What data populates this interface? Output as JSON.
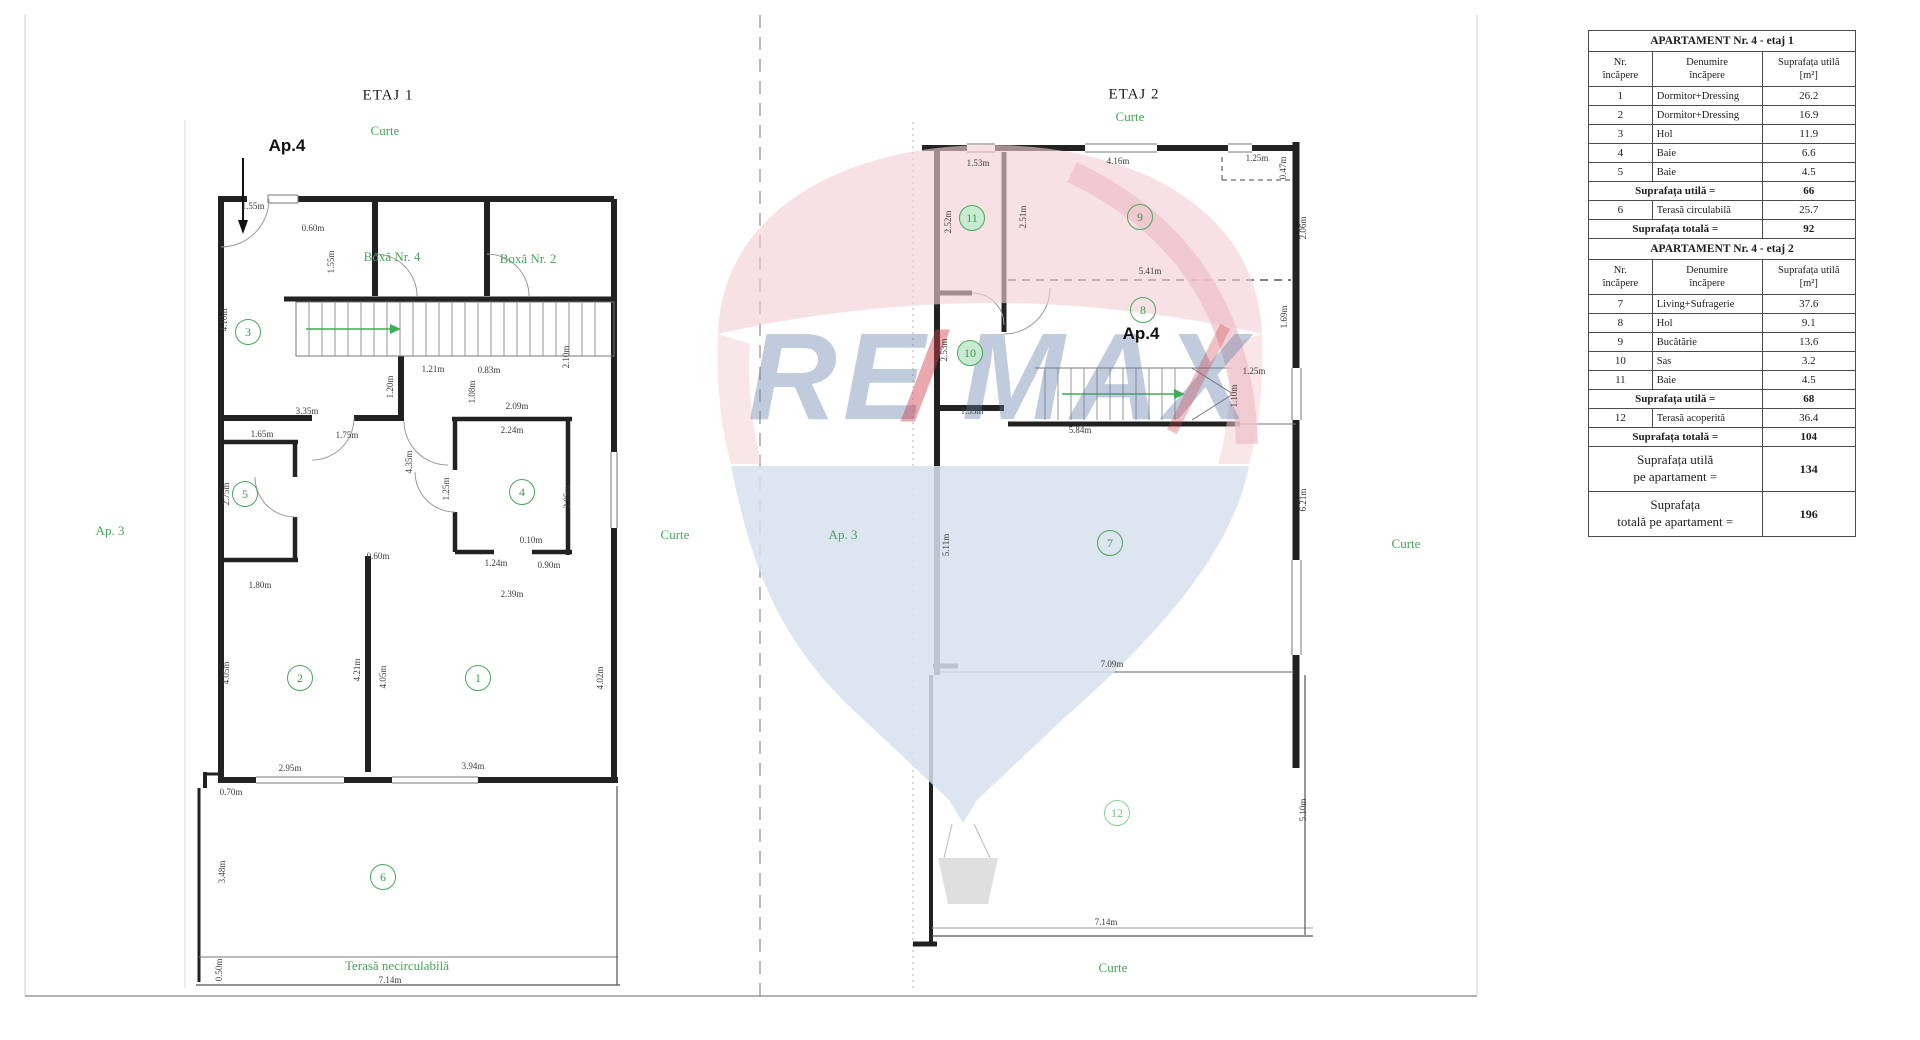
{
  "colors": {
    "green_label": "#46a558",
    "green_circle": "#4aa85c",
    "wall": "#222222",
    "thin_line": "#777777",
    "arrow_green": "#3fae52",
    "watermark_blue": "#617eaa",
    "watermark_red": "#ce424c",
    "balloon_pink": "#f3ced4",
    "balloon_blue": "#d7e0ed"
  },
  "watermark": {
    "re": "RE",
    "slash": "/",
    "max": "MAX"
  },
  "plans": {
    "etaj1": {
      "title": "ETAJ 1",
      "title_pos": {
        "x": 388,
        "y": 96
      },
      "apartment_label": "Ap.4",
      "apartment_pos": {
        "x": 287,
        "y": 146
      },
      "area_labels": [
        {
          "text": "Curte",
          "x": 385,
          "y": 131
        },
        {
          "text": "Boxă Nr. 4",
          "x": 392,
          "y": 257
        },
        {
          "text": "Boxă Nr. 2",
          "x": 528,
          "y": 259
        },
        {
          "text": "Ap. 3",
          "x": 110,
          "y": 531
        },
        {
          "text": "Curte",
          "x": 675,
          "y": 535
        },
        {
          "text": "Terasă necirculabilă",
          "x": 397,
          "y": 966
        }
      ],
      "rooms": [
        {
          "n": "3",
          "x": 248,
          "y": 332
        },
        {
          "n": "5",
          "x": 245,
          "y": 494
        },
        {
          "n": "4",
          "x": 522,
          "y": 492
        },
        {
          "n": "2",
          "x": 300,
          "y": 678
        },
        {
          "n": "1",
          "x": 478,
          "y": 678
        },
        {
          "n": "6",
          "x": 383,
          "y": 877
        }
      ],
      "dims": [
        {
          "t": "1.55m",
          "x": 253,
          "y": 206
        },
        {
          "t": "0.60m",
          "x": 313,
          "y": 228
        },
        {
          "t": "1.55m",
          "x": 331,
          "y": 262,
          "v": true
        },
        {
          "t": "4.10m",
          "x": 224,
          "y": 320,
          "v": true
        },
        {
          "t": "3.35m",
          "x": 307,
          "y": 411
        },
        {
          "t": "1.21m",
          "x": 433,
          "y": 369
        },
        {
          "t": "0.83m",
          "x": 489,
          "y": 370
        },
        {
          "t": "1.20m",
          "x": 390,
          "y": 387,
          "v": true
        },
        {
          "t": "1.08m",
          "x": 472,
          "y": 392,
          "v": true
        },
        {
          "t": "2.10m",
          "x": 566,
          "y": 357,
          "v": true
        },
        {
          "t": "1.65m",
          "x": 262,
          "y": 434
        },
        {
          "t": "1.75m",
          "x": 347,
          "y": 435
        },
        {
          "t": "2.09m",
          "x": 517,
          "y": 406
        },
        {
          "t": "2.24m",
          "x": 512,
          "y": 430
        },
        {
          "t": "2.75m",
          "x": 226,
          "y": 494,
          "v": true
        },
        {
          "t": "1.25m",
          "x": 446,
          "y": 489,
          "v": true
        },
        {
          "t": "4.35m",
          "x": 409,
          "y": 462,
          "v": true
        },
        {
          "t": "2.05m",
          "x": 567,
          "y": 497,
          "v": true
        },
        {
          "t": "0.10m",
          "x": 531,
          "y": 540
        },
        {
          "t": "1.24m",
          "x": 496,
          "y": 563
        },
        {
          "t": "0.90m",
          "x": 549,
          "y": 565
        },
        {
          "t": "0.60m",
          "x": 378,
          "y": 556
        },
        {
          "t": "1.80m",
          "x": 260,
          "y": 585
        },
        {
          "t": "2.39m",
          "x": 512,
          "y": 594
        },
        {
          "t": "4.05m",
          "x": 226,
          "y": 673,
          "v": true
        },
        {
          "t": "4.21m",
          "x": 357,
          "y": 670,
          "v": true
        },
        {
          "t": "4.05m",
          "x": 383,
          "y": 677,
          "v": true
        },
        {
          "t": "4.02m",
          "x": 600,
          "y": 678,
          "v": true
        },
        {
          "t": "2.95m",
          "x": 290,
          "y": 768
        },
        {
          "t": "3.94m",
          "x": 473,
          "y": 766
        },
        {
          "t": "0.70m",
          "x": 231,
          "y": 792
        },
        {
          "t": "3.48m",
          "x": 222,
          "y": 872,
          "v": true
        },
        {
          "t": "0.50m",
          "x": 219,
          "y": 970,
          "v": true
        },
        {
          "t": "7.14m",
          "x": 390,
          "y": 980
        }
      ]
    },
    "etaj2": {
      "title": "ETAJ 2",
      "title_pos": {
        "x": 1134,
        "y": 95
      },
      "apartment_label": "Ap.4",
      "apartment_pos": {
        "x": 1141,
        "y": 334
      },
      "area_labels": [
        {
          "text": "Curte",
          "x": 1130,
          "y": 117
        },
        {
          "text": "Ap. 3",
          "x": 843,
          "y": 535
        },
        {
          "text": "Curte",
          "x": 1406,
          "y": 544
        },
        {
          "text": "Curte",
          "x": 1113,
          "y": 968
        }
      ],
      "rooms": [
        {
          "n": "11",
          "x": 972,
          "y": 218,
          "filled": true
        },
        {
          "n": "9",
          "x": 1140,
          "y": 217
        },
        {
          "n": "8",
          "x": 1143,
          "y": 310
        },
        {
          "n": "10",
          "x": 970,
          "y": 353,
          "filled": true
        },
        {
          "n": "7",
          "x": 1110,
          "y": 543
        },
        {
          "n": "12",
          "x": 1117,
          "y": 813,
          "light": true
        }
      ],
      "dims": [
        {
          "t": "1.53m",
          "x": 978,
          "y": 163
        },
        {
          "t": "4.16m",
          "x": 1118,
          "y": 161
        },
        {
          "t": "1.25m",
          "x": 1257,
          "y": 158
        },
        {
          "t": "0.47m",
          "x": 1283,
          "y": 168,
          "v": true
        },
        {
          "t": "2.52m",
          "x": 948,
          "y": 222,
          "v": true
        },
        {
          "t": "2.51m",
          "x": 1023,
          "y": 217,
          "v": true
        },
        {
          "t": "2.06m",
          "x": 1303,
          "y": 228,
          "v": true
        },
        {
          "t": "5.41m",
          "x": 1150,
          "y": 271
        },
        {
          "t": "1.69m",
          "x": 1284,
          "y": 317,
          "v": true
        },
        {
          "t": "2.53m",
          "x": 944,
          "y": 350,
          "v": true
        },
        {
          "t": "1.53m",
          "x": 972,
          "y": 411
        },
        {
          "t": "5.84m",
          "x": 1080,
          "y": 430
        },
        {
          "t": "1.25m",
          "x": 1254,
          "y": 371
        },
        {
          "t": "1.10m",
          "x": 1234,
          "y": 396,
          "v": true
        },
        {
          "t": "5.11m",
          "x": 946,
          "y": 545,
          "v": true
        },
        {
          "t": "6.21m",
          "x": 1303,
          "y": 500,
          "v": true
        },
        {
          "t": "7.09m",
          "x": 1112,
          "y": 664
        },
        {
          "t": "5.10m",
          "x": 1303,
          "y": 810,
          "v": true
        },
        {
          "t": "7.14m",
          "x": 1106,
          "y": 922
        }
      ]
    }
  },
  "table": {
    "rows": [
      {
        "type": "title",
        "text": "APARTAMENT Nr. 4 - etaj 1"
      },
      {
        "type": "header",
        "c1": "Nr.\nîncăpere",
        "c2": "Denumire\nîncăpere",
        "c3": "Suprafața utilă\n[m²]"
      },
      {
        "type": "room",
        "nr": "1",
        "name": "Dormitor+Dressing",
        "area": "26.2"
      },
      {
        "type": "room",
        "nr": "2",
        "name": "Dormitor+Dressing",
        "area": "16.9"
      },
      {
        "type": "room",
        "nr": "3",
        "name": "Hol",
        "area": "11.9"
      },
      {
        "type": "room",
        "nr": "4",
        "name": "Baie",
        "area": "6.6"
      },
      {
        "type": "room",
        "nr": "5",
        "name": "Baie",
        "area": "4.5"
      },
      {
        "type": "total",
        "label": "Suprafața utilă =",
        "value": "66"
      },
      {
        "type": "room",
        "nr": "6",
        "name": "Terasă circulabilă",
        "area": "25.7"
      },
      {
        "type": "total",
        "label": "Suprafața totală =",
        "value": "92"
      },
      {
        "type": "title",
        "text": "APARTAMENT Nr. 4 - etaj 2"
      },
      {
        "type": "header",
        "c1": "Nr.\nîncăpere",
        "c2": "Denumire\nîncăpere",
        "c3": "Suprafața utilă\n[m²]"
      },
      {
        "type": "room",
        "nr": "7",
        "name": "Living+Sufragerie",
        "area": "37.6"
      },
      {
        "type": "room",
        "nr": "8",
        "name": "Hol",
        "area": "9.1"
      },
      {
        "type": "room",
        "nr": "9",
        "name": "Bucătărie",
        "area": "13.6"
      },
      {
        "type": "room",
        "nr": "10",
        "name": "Sas",
        "area": "3.2"
      },
      {
        "type": "room",
        "nr": "11",
        "name": "Baie",
        "area": "4.5"
      },
      {
        "type": "total",
        "label": "Suprafața utilă =",
        "value": "68"
      },
      {
        "type": "room",
        "nr": "12",
        "name": "Terasă acoperită",
        "area": "36.4"
      },
      {
        "type": "total",
        "label": "Suprafața totală =",
        "value": "104"
      },
      {
        "type": "grand",
        "label": "Suprafața utilă\npe apartament =",
        "value": "134"
      },
      {
        "type": "grand",
        "label": "Suprafața\ntotală pe apartament =",
        "value": "196"
      }
    ]
  }
}
